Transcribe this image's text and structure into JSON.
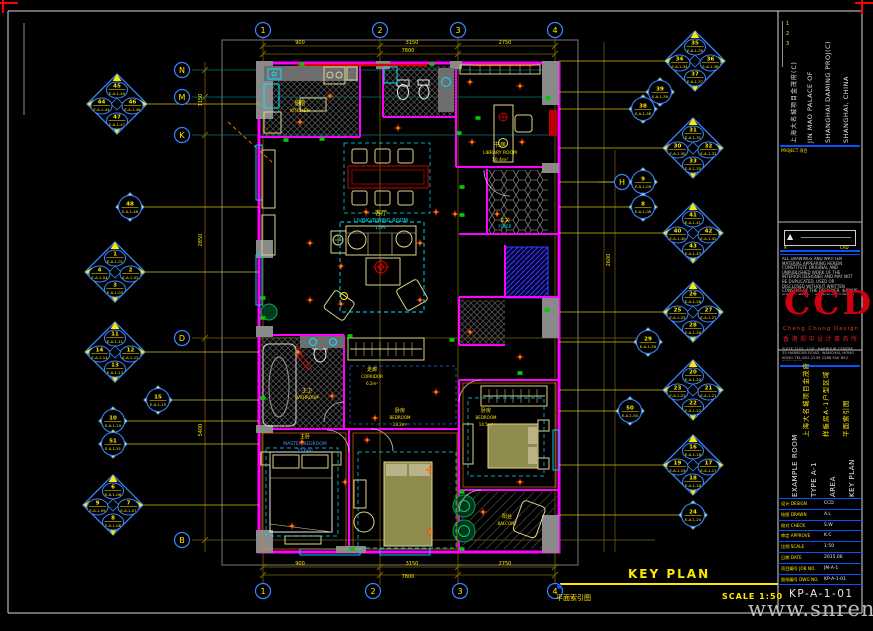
{
  "titleblock": {
    "revisions": [
      "1",
      "2",
      "3"
    ],
    "project": {
      "cn": "上海大名城项目金茂府(C)",
      "en_cols": [
        "JIN MAO PALACE OF",
        "SHANGHAI DAMING PROJ(C)",
        "SHANGHAI, CHINA"
      ],
      "rule_label": "PROJECT 项目"
    },
    "consultant": {
      "mark": "▲",
      "left": "A",
      "right": "CAD"
    },
    "notes": "ALL DRAWINGS AND WRITTEN MATERIAL APPEARING HEREIN CONSTITUTE ORIGINAL AND UNPUBLISHED WORK OF THE INTERIOR DESIGNER AND MAY NOT BE DUPLICATED, USED OR DISCLOSED WITHOUT WRITTEN CONSENT OF THE DESIGNER. 本图纸版权归设计师所有，未经书面许可不得复制、使用或泄露。",
    "logo": {
      "text": "CCD",
      "sub": "Cheng Chung Design",
      "sub_cn": "香港郑中设计事务所"
    },
    "address": "SUITE 2101, 21/F., HARBOUR CENTRE, 25 HARBOUR ROAD, WANCHAI, HONG KONG  TEL 852 2239 2288  FAX 852 2239 2299",
    "cn_cols": [
      "上海大名城项目金茂府",
      "样板房A-1户型区域",
      "平面索引图"
    ],
    "en_cols": [
      "EXAMPLE ROOM",
      "TYPE A-1",
      "AREA",
      "KEY PLAN"
    ],
    "fields": [
      {
        "l": "设计 DESIGN",
        "v": "CCD"
      },
      {
        "l": "绘图 DRAWN",
        "v": "A.L"
      },
      {
        "l": "校对 CHECK",
        "v": "S.W"
      },
      {
        "l": "审定 APPROVE",
        "v": "K.C"
      },
      {
        "l": "比例 SCALE",
        "v": "1:50"
      },
      {
        "l": "日期 DATE",
        "v": "2015.06"
      },
      {
        "l": "项目编号 JOB NO.",
        "v": "JM-A-1"
      },
      {
        "l": "图纸编号 DWG NO.",
        "v": "KP-A-1-01"
      }
    ],
    "drawing_number": "KP-A-1-01"
  },
  "footer": {
    "title": "KEY PLAN",
    "caption_cn": "平面索引图",
    "scale": "SCALE 1:50",
    "watermark": "www.snren.com"
  },
  "grid": {
    "bubbles": [
      {
        "x": 263,
        "y": 30,
        "l": "1"
      },
      {
        "x": 380,
        "y": 30,
        "l": "2"
      },
      {
        "x": 458,
        "y": 30,
        "l": "3"
      },
      {
        "x": 555,
        "y": 30,
        "l": "4"
      },
      {
        "x": 263,
        "y": 591,
        "l": "1"
      },
      {
        "x": 373,
        "y": 591,
        "l": "2"
      },
      {
        "x": 460,
        "y": 591,
        "l": "3"
      },
      {
        "x": 555,
        "y": 591,
        "l": "4"
      },
      {
        "x": 182,
        "y": 70,
        "l": "N"
      },
      {
        "x": 182,
        "y": 97,
        "l": "M"
      },
      {
        "x": 182,
        "y": 135,
        "l": "K"
      },
      {
        "x": 182,
        "y": 338,
        "l": "D"
      },
      {
        "x": 182,
        "y": 540,
        "l": "B"
      },
      {
        "x": 622,
        "y": 182,
        "l": "H"
      }
    ]
  },
  "markers": {
    "code_prefix": "E-A-1-",
    "items": [
      {
        "x": 117,
        "y": 104,
        "t": "quad",
        "n": [
          "45",
          "44",
          "46",
          "47"
        ]
      },
      {
        "x": 130,
        "y": 207,
        "t": "single",
        "n": [
          "48"
        ]
      },
      {
        "x": 115,
        "y": 272,
        "t": "quad",
        "n": [
          "1",
          "4",
          "2",
          "3"
        ]
      },
      {
        "x": 115,
        "y": 352,
        "t": "quad",
        "n": [
          "11",
          "14",
          "12",
          "13"
        ]
      },
      {
        "x": 158,
        "y": 400,
        "t": "single",
        "n": [
          "15"
        ]
      },
      {
        "x": 113,
        "y": 421,
        "t": "single",
        "n": [
          "10"
        ]
      },
      {
        "x": 113,
        "y": 444,
        "t": "single",
        "n": [
          "51"
        ]
      },
      {
        "x": 113,
        "y": 505,
        "t": "quad",
        "n": [
          "6",
          "9",
          "7",
          "8"
        ]
      },
      {
        "x": 695,
        "y": 61,
        "t": "quad",
        "n": [
          "35",
          "34",
          "36",
          "37"
        ]
      },
      {
        "x": 660,
        "y": 92,
        "t": "single",
        "n": [
          "39"
        ]
      },
      {
        "x": 643,
        "y": 109,
        "t": "single",
        "n": [
          "38"
        ]
      },
      {
        "x": 693,
        "y": 148,
        "t": "quad",
        "n": [
          "31",
          "30",
          "32",
          "33"
        ]
      },
      {
        "x": 643,
        "y": 182,
        "t": "single",
        "n": [
          "9"
        ]
      },
      {
        "x": 643,
        "y": 207,
        "t": "single",
        "n": [
          "8"
        ]
      },
      {
        "x": 693,
        "y": 233,
        "t": "quad",
        "n": [
          "41",
          "40",
          "42",
          "43"
        ]
      },
      {
        "x": 693,
        "y": 312,
        "t": "quad",
        "n": [
          "26",
          "25",
          "27",
          "28"
        ]
      },
      {
        "x": 648,
        "y": 342,
        "t": "single",
        "n": [
          "29"
        ]
      },
      {
        "x": 693,
        "y": 390,
        "t": "quad",
        "n": [
          "20",
          "23",
          "21",
          "22"
        ]
      },
      {
        "x": 630,
        "y": 411,
        "t": "single",
        "n": [
          "50"
        ]
      },
      {
        "x": 693,
        "y": 465,
        "t": "quad",
        "n": [
          "16",
          "19",
          "17",
          "18"
        ]
      },
      {
        "x": 693,
        "y": 515,
        "t": "single",
        "n": [
          "24"
        ]
      }
    ]
  },
  "plan": {
    "rooms": {
      "kitchen": {
        "cn": "厨房",
        "en": "KITCHEN"
      },
      "living": {
        "cn": "客厅",
        "en": "LIVING/DINING ROOM",
        "area": "15m²"
      },
      "library": {
        "cn": "书房",
        "en": "LIBRARY ROOM",
        "area": "10.4m²"
      },
      "foyer": {
        "cn": "玄关",
        "en": "FOYER"
      },
      "corridor": {
        "cn": "走廊",
        "en": "CORRIDOR",
        "area": "6.2m²"
      },
      "master_bath": {
        "cn": "主卫",
        "en": "BATHROOM"
      },
      "master_bed": {
        "cn": "主卧",
        "en": "MASTER BEDROOM",
        "area": "15.6m²"
      },
      "bedroom2": {
        "cn": "卧房",
        "en": "BEDROOM",
        "area": "13.2m²"
      },
      "bedroom3": {
        "cn": "卧房",
        "en": "BEDROOM",
        "area": "14.5m²"
      },
      "balcony": {
        "cn": "阳台",
        "en": "BALCONY"
      }
    },
    "dims": [
      {
        "x": 300,
        "y": 44,
        "t": "900"
      },
      {
        "x": 412,
        "y": 44,
        "t": "3150"
      },
      {
        "x": 505,
        "y": 44,
        "t": "2750"
      },
      {
        "x": 408,
        "y": 52,
        "t": "7800"
      },
      {
        "x": 300,
        "y": 565,
        "t": "900"
      },
      {
        "x": 412,
        "y": 565,
        "t": "3150"
      },
      {
        "x": 505,
        "y": 565,
        "t": "2750"
      },
      {
        "x": 408,
        "y": 578,
        "t": "7800"
      },
      {
        "x": 202,
        "y": 100,
        "t": "1150",
        "r": 1
      },
      {
        "x": 202,
        "y": 240,
        "t": "2850",
        "r": 1
      },
      {
        "x": 202,
        "y": 430,
        "t": "5400",
        "r": 1
      },
      {
        "x": 610,
        "y": 260,
        "t": "2600",
        "r": 1
      }
    ],
    "lights": [
      [
        310,
        243
      ],
      [
        420,
        243
      ],
      [
        310,
        300
      ],
      [
        420,
        300
      ],
      [
        366,
        212
      ],
      [
        436,
        212
      ],
      [
        300,
        122
      ],
      [
        330,
        96
      ],
      [
        398,
        128
      ],
      [
        470,
        82
      ],
      [
        520,
        86
      ],
      [
        472,
        142
      ],
      [
        522,
        142
      ],
      [
        298,
        352
      ],
      [
        332,
        396
      ],
      [
        367,
        440
      ],
      [
        436,
        392
      ],
      [
        470,
        332
      ],
      [
        520,
        357
      ],
      [
        345,
        482
      ],
      [
        302,
        442
      ],
      [
        430,
        470
      ],
      [
        520,
        482
      ],
      [
        483,
        512
      ],
      [
        292,
        526
      ],
      [
        430,
        532
      ],
      [
        375,
        418
      ],
      [
        341,
        266
      ],
      [
        341,
        304
      ],
      [
        455,
        214
      ],
      [
        497,
        214
      ]
    ],
    "sockets": [
      [
        286,
        140
      ],
      [
        322,
        139
      ],
      [
        459,
        133
      ],
      [
        478,
        118
      ],
      [
        462,
        187
      ],
      [
        462,
        215
      ],
      [
        263,
        298
      ],
      [
        263,
        318
      ],
      [
        350,
        336
      ],
      [
        452,
        340
      ],
      [
        520,
        373
      ],
      [
        462,
        492
      ],
      [
        263,
        398
      ],
      [
        548,
        98
      ],
      [
        352,
        549
      ],
      [
        462,
        549
      ],
      [
        432,
        64
      ],
      [
        302,
        64
      ],
      [
        547,
        310
      ]
    ]
  }
}
